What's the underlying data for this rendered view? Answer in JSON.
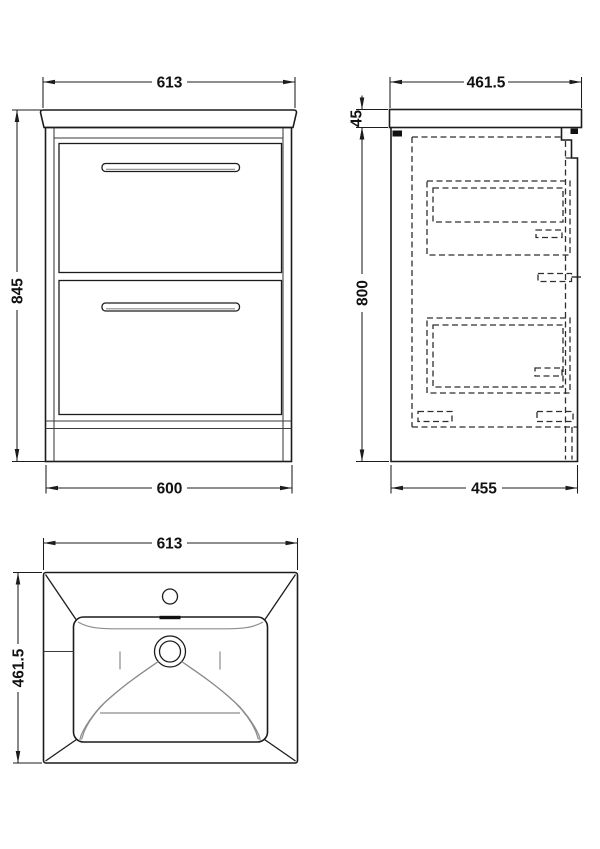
{
  "drawing": {
    "title": "vanity-unit-technical-drawing",
    "background": "#ffffff",
    "ink": "#1c1c1c",
    "views": {
      "front": {
        "dim_width_top": "613",
        "dim_height_left": "845",
        "dim_width_bottom": "600"
      },
      "side": {
        "dim_width_top": "461.5",
        "dim_worktop_height": "45",
        "dim_cabinet_height": "800",
        "dim_width_bottom": "455"
      },
      "plan": {
        "dim_width_top": "613",
        "dim_depth_left": "461.5"
      }
    }
  }
}
